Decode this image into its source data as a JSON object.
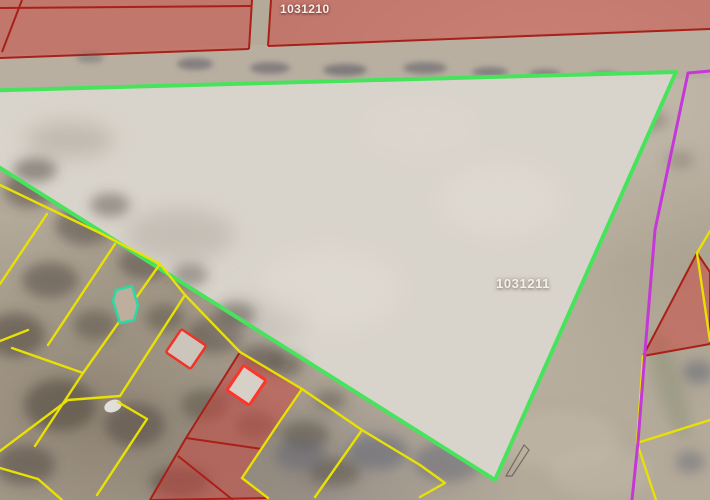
{
  "map": {
    "parcels": [
      {
        "label": "1031210",
        "outline_color": "#a82018",
        "fill": "rgba(205,68,60,0.5)"
      },
      {
        "label": "1031211",
        "outline_color": "#48e35c",
        "fill": "#d9d4cb"
      }
    ],
    "colors": {
      "selected_parcel_green": "#48e35c",
      "parcel_boundary_yellow": "#e9e103",
      "boundary_magenta": "#c438d8",
      "boundary_dark_red": "#a82018",
      "restricted_fill": "rgba(205,68,60,0.5)",
      "building_red_outline": "#f03227",
      "building_bright_red_outline": "#ff342a",
      "building_teal_outline": "#2ed8a2"
    }
  }
}
